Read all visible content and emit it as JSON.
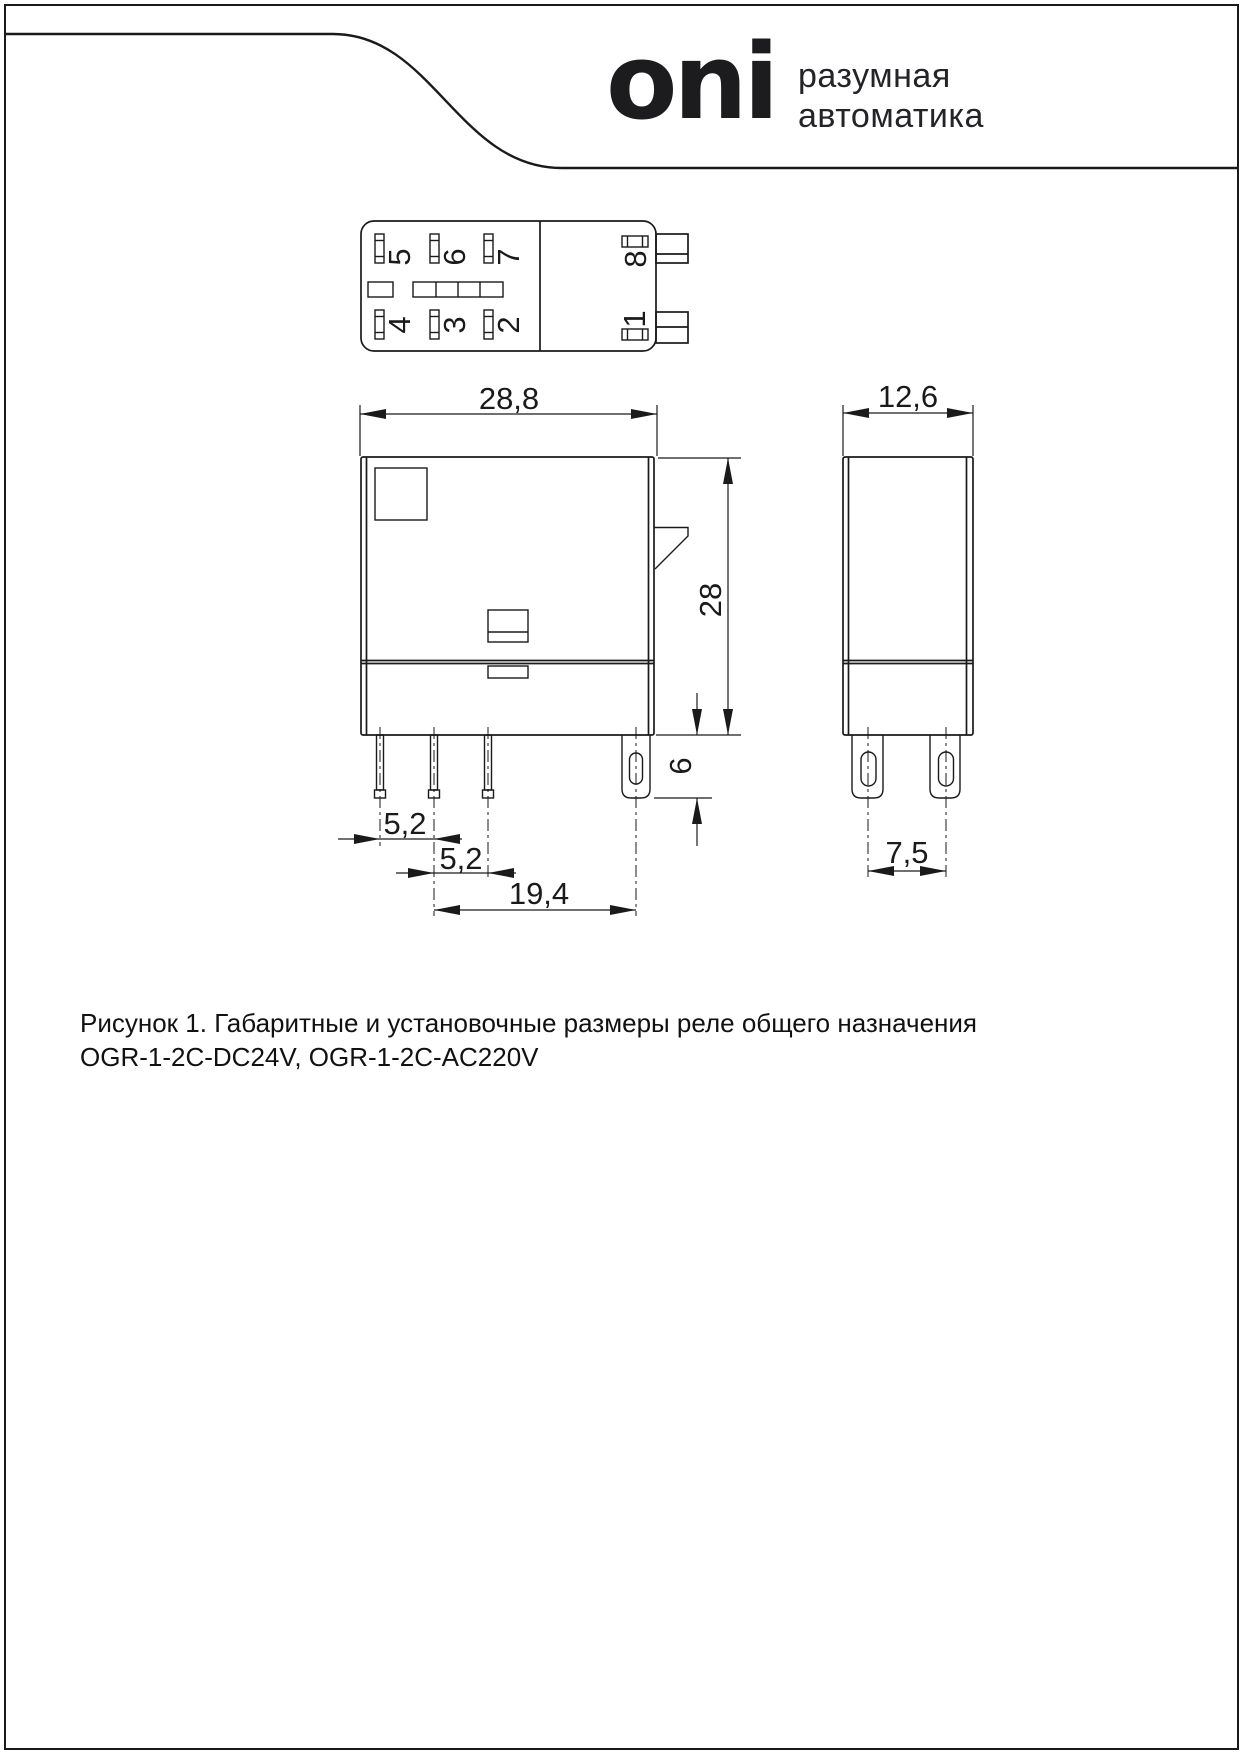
{
  "brand": {
    "logo": "oni",
    "tagline_line1": "разумная",
    "tagline_line2": "автоматика"
  },
  "top_view": {
    "pin_labels": {
      "p5": "5",
      "p6": "6",
      "p7": "7",
      "p4": "4",
      "p3": "3",
      "p2": "2",
      "p8": "8",
      "p1": "1"
    }
  },
  "dimensions": {
    "front_width": "28,8",
    "front_height": "28",
    "pin_length": "6",
    "pitch_a": "5,2",
    "pitch_b": "5,2",
    "pitch_mount": "19,4",
    "side_width": "12,6",
    "side_pin_pitch": "7,5"
  },
  "figure": {
    "caption_line1": "Рисунок 1. Габаритные и установочные размеры реле общего назначения",
    "caption_line2": "OGR-1-2C-DC24V, OGR-1-2C-AC220V"
  },
  "colors": {
    "line": "#1a1a1a",
    "background": "#ffffff"
  }
}
